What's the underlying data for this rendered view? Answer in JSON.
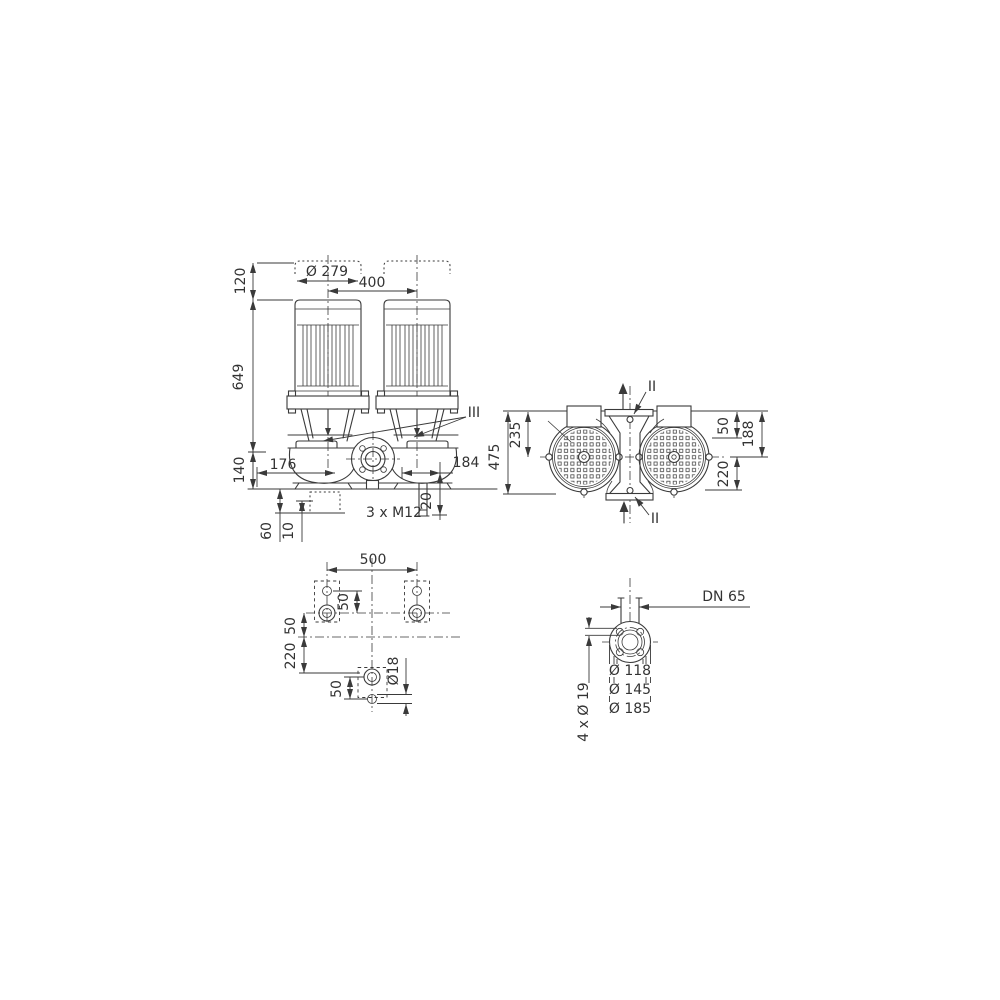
{
  "drawing_type": "pump-dimensional-drawing",
  "colors": {
    "line": "#3a3a3a",
    "text": "#333333",
    "background": "#ffffff"
  },
  "views": {
    "front": {
      "name": "front-view-twin-pump",
      "labels": {
        "d120": "120",
        "d649": "649",
        "d140": "140",
        "d279": "Ø 279",
        "d400": "400",
        "d176": "176",
        "d184": "184",
        "d20": "20",
        "m12": "3 x M12",
        "d60": "60",
        "d10": "10",
        "section": "III"
      }
    },
    "top": {
      "name": "top-view-twin-pump",
      "labels": {
        "d475": "475",
        "d235": "235",
        "d50": "50",
        "d188": "188",
        "d220": "220",
        "section_top": "II",
        "section_bottom": "II"
      }
    },
    "foundation": {
      "name": "foundation-plan",
      "labels": {
        "d500": "500",
        "d50_pitch": "50",
        "d50_left": "50",
        "d220": "220",
        "d50_bottom": "50",
        "d18": "Ø18"
      }
    },
    "flange": {
      "name": "flange-detail",
      "labels": {
        "dn": "DN 65",
        "d118": "Ø 118",
        "d145": "Ø 145",
        "d185": "Ø 185",
        "holes": "4 x Ø 19"
      }
    }
  }
}
